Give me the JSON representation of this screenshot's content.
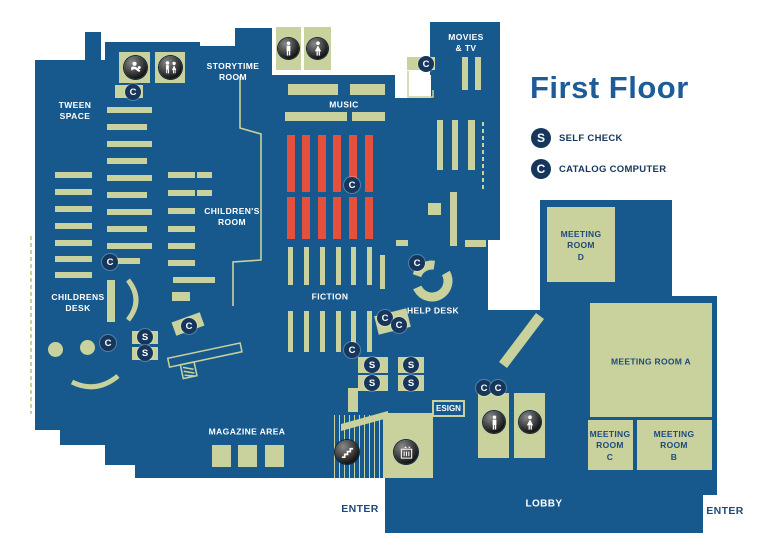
{
  "title": "First Floor",
  "legend": {
    "self_check": {
      "symbol": "S",
      "label": "SELF CHECK"
    },
    "catalog": {
      "symbol": "C",
      "label": "CATALOG COMPUTER"
    }
  },
  "badges": {
    "self_check": "S",
    "catalog": "C"
  },
  "areas": {
    "tween_space": [
      "TWEEN",
      "SPACE"
    ],
    "storytime_room": [
      "STORYTIME",
      "ROOM"
    ],
    "childrens_room": [
      "CHILDREN'S",
      "ROOM"
    ],
    "childrens_desk": [
      "CHILDRENS",
      "DESK"
    ],
    "music": "MUSIC",
    "fiction": "FICTION",
    "movies_tv": [
      "MOVIES",
      "& TV"
    ],
    "help_desk": "HELP DESK",
    "magazine_area": "MAGAZINE AREA",
    "meeting_room_d": [
      "MEETING",
      "ROOM",
      "D"
    ],
    "meeting_room_a": "MEETING ROOM A",
    "meeting_room_c": [
      "MEETING",
      "ROOM",
      "C"
    ],
    "meeting_room_b": [
      "MEETING",
      "ROOM",
      "B"
    ],
    "lobby": "LOBBY",
    "esign": "ESIGN",
    "enter_left": "ENTER",
    "enter_right": "ENTER"
  },
  "icons": [
    "baby-changing-icon",
    "family-restroom-icon",
    "mens-restroom-icon",
    "womens-restroom-icon",
    "mens-restroom-icon",
    "womens-restroom-icon",
    "stairs-icon",
    "elevator-icon"
  ],
  "colors": {
    "floor_blue": "#17598c",
    "shelf_green": "#c9d19c",
    "accent_red": "#e5503c",
    "badge_navy": "#16365c",
    "title_blue": "#1d5c97"
  }
}
